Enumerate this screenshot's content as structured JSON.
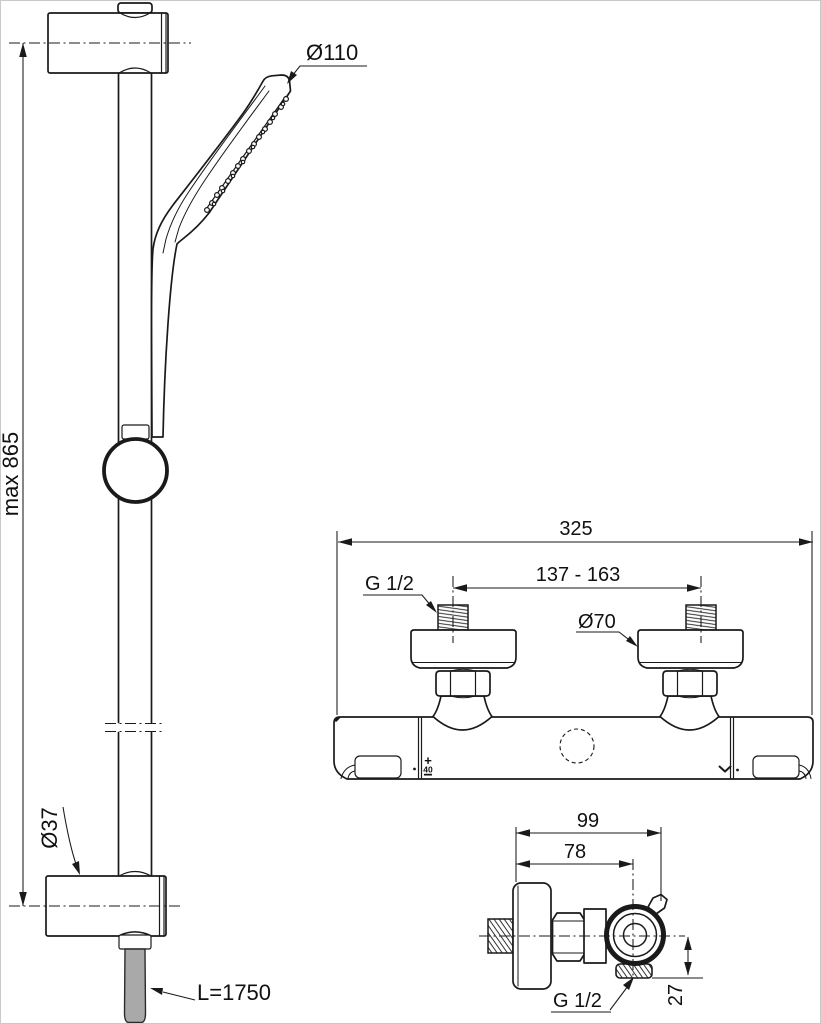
{
  "colors": {
    "line": "#1a1a1a",
    "hose_fill": "#a9a9a9",
    "background": "#ffffff"
  },
  "rail_figure": {
    "max_height_label": "max 865",
    "handshower_diameter_label": "Ø110",
    "bracket_diameter_label": "Ø37",
    "hose_length_label": "L=1750"
  },
  "mixer_front_figure": {
    "overall_width_label": "325",
    "inlet_spacing_label": "137 - 163",
    "thread_label": "G 1/2",
    "escutcheon_diameter_label": "Ø70",
    "temperature_plus_label": "+",
    "temperature_value_label": "40",
    "temperature_minus_label": "−",
    "flow_marking_icon": "chevron-down"
  },
  "mixer_side_figure": {
    "depth_label": "99",
    "handle_depth_label": "78",
    "thread_label": "G 1/2",
    "outlet_offset_label": "27"
  }
}
